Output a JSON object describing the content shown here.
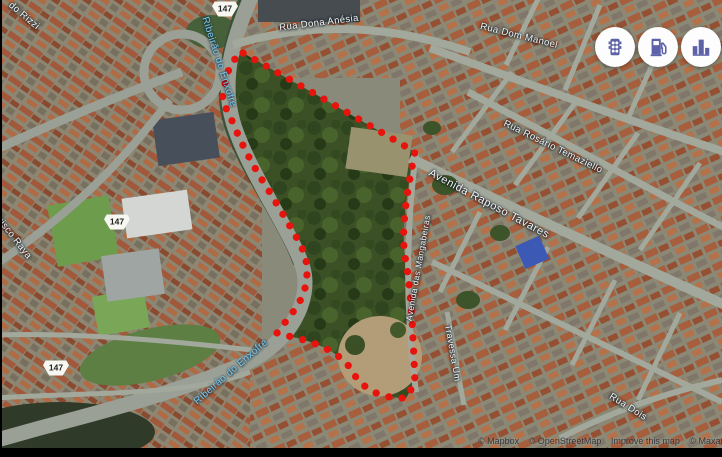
{
  "street_labels": [
    {
      "text": "Rua Dona Anésia"
    },
    {
      "text": "Rua Dom Manoel"
    },
    {
      "text": "Rua Rosário Temaziello"
    },
    {
      "text": "Avenida Raposo Tavares"
    },
    {
      "text": "Avenida das Mangabeiras"
    },
    {
      "text": "Travessa Um"
    },
    {
      "text": "Rua Dois"
    },
    {
      "text": "do Rizzi"
    },
    {
      "text": "cisco Raya"
    }
  ],
  "water_labels": [
    {
      "text": "Ribeirão do Enxofre"
    },
    {
      "text": "Ribeirão do Enxofre"
    }
  ],
  "route_shields": [
    {
      "number": "147"
    },
    {
      "number": "147"
    },
    {
      "number": "147"
    }
  ],
  "map_buttons": [
    {
      "icon": "traffic-light"
    },
    {
      "icon": "fuel-station"
    },
    {
      "icon": "buildings"
    }
  ],
  "attribution": {
    "mapbox": "© Mapbox",
    "osm": "© OpenStreetMap",
    "improve": "Improve this map",
    "imagery": "© Maxar"
  },
  "colors": {
    "boundary": "#e8130c",
    "water_label": "#7cc8ee",
    "button_icon": "#5c61a8"
  }
}
